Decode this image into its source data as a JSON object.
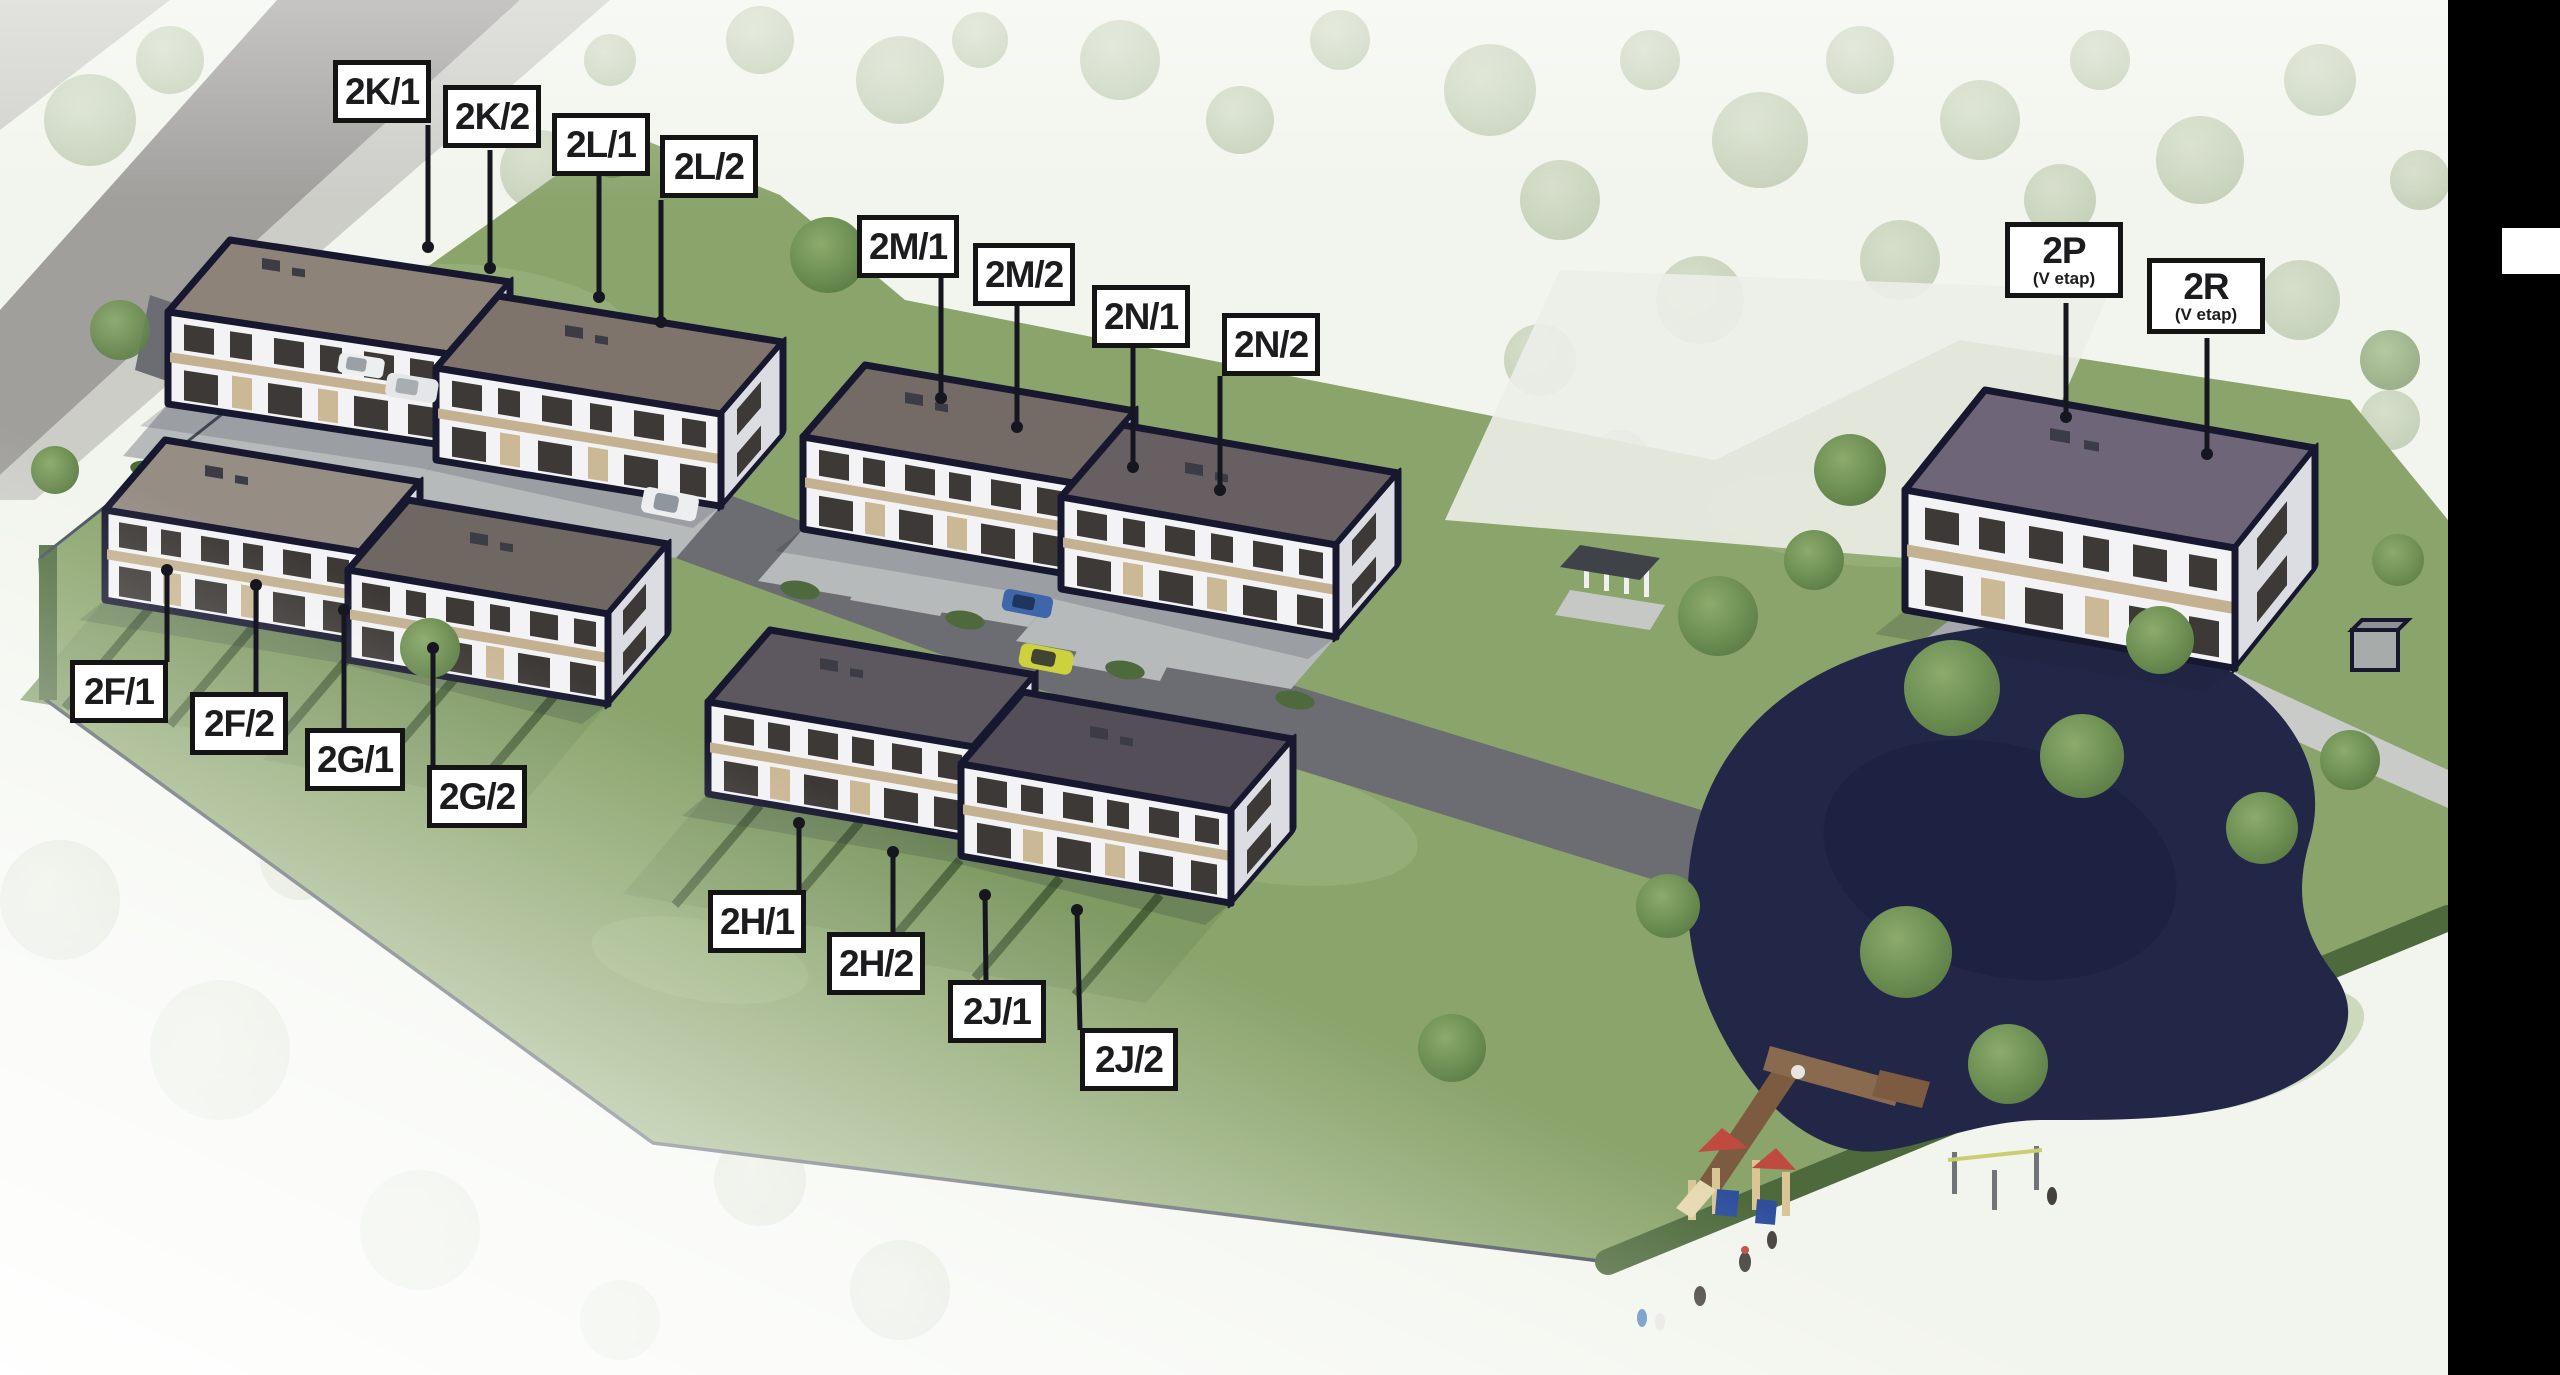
{
  "scene": {
    "type": "residential-development-site-plan",
    "view": "aerial-3d-rendering",
    "features": [
      "townhouse buildings",
      "internal road",
      "driveways",
      "gardens with hedges",
      "pond",
      "wooden dock",
      "playground",
      "outdoor gym",
      "pergola",
      "perimeter fence",
      "trees"
    ]
  },
  "units": [
    {
      "id": "2K/1",
      "label": "2K/1"
    },
    {
      "id": "2K/2",
      "label": "2K/2"
    },
    {
      "id": "2L/1",
      "label": "2L/1"
    },
    {
      "id": "2L/2",
      "label": "2L/2"
    },
    {
      "id": "2M/1",
      "label": "2M/1"
    },
    {
      "id": "2M/2",
      "label": "2M/2"
    },
    {
      "id": "2N/1",
      "label": "2N/1"
    },
    {
      "id": "2N/2",
      "label": "2N/2"
    },
    {
      "id": "2F/1",
      "label": "2F/1"
    },
    {
      "id": "2F/2",
      "label": "2F/2"
    },
    {
      "id": "2G/1",
      "label": "2G/1"
    },
    {
      "id": "2G/2",
      "label": "2G/2"
    },
    {
      "id": "2H/1",
      "label": "2H/1"
    },
    {
      "id": "2H/2",
      "label": "2H/2"
    },
    {
      "id": "2J/1",
      "label": "2J/1"
    },
    {
      "id": "2J/2",
      "label": "2J/2"
    },
    {
      "id": "2P",
      "label": "2P",
      "sub": "(V etap)"
    },
    {
      "id": "2R",
      "label": "2R",
      "sub": "(V etap)"
    }
  ],
  "buildings": [
    {
      "name": "2K-2L",
      "units": [
        "2K/1",
        "2K/2",
        "2L/1",
        "2L/2"
      ]
    },
    {
      "name": "2M-2N",
      "units": [
        "2M/1",
        "2M/2",
        "2N/1",
        "2N/2"
      ]
    },
    {
      "name": "2F-2G",
      "units": [
        "2F/1",
        "2F/2",
        "2G/1",
        "2G/2"
      ]
    },
    {
      "name": "2H-2J",
      "units": [
        "2H/1",
        "2H/2",
        "2J/1",
        "2J/2"
      ]
    },
    {
      "name": "2P-2R",
      "units": [
        "2P",
        "2R"
      ]
    }
  ],
  "colors": {
    "label_bg": "#ffffff",
    "label_border": "#141414",
    "label_text": "#1c1c1e",
    "leader_line": "#15161f",
    "grass": "#8aa46b",
    "grass_light": "#a3ba84",
    "hedge": "#4e6a3c",
    "tree": "#739558",
    "road_asphalt": "#6b6d72",
    "road_main": "#a09f9c",
    "sidewalk": "#cdcdc8",
    "driveway": "#b7babb",
    "building_wall": "#f3f3f5",
    "building_outline": "#171830",
    "accent_tan": "#c3b191",
    "window": "#3d3936",
    "pond": "#222747",
    "dock_wood": "#7d5b40",
    "letterbox_bar": "#000000",
    "bar_marker": "#ffffff",
    "car_blue": "#3e66a8",
    "car_yellow": "#ccd23e",
    "car_white": "#eceef0",
    "playground_red": "#c04a40",
    "playground_blue": "#2f4f9e",
    "playground_wood": "#d9c596"
  }
}
